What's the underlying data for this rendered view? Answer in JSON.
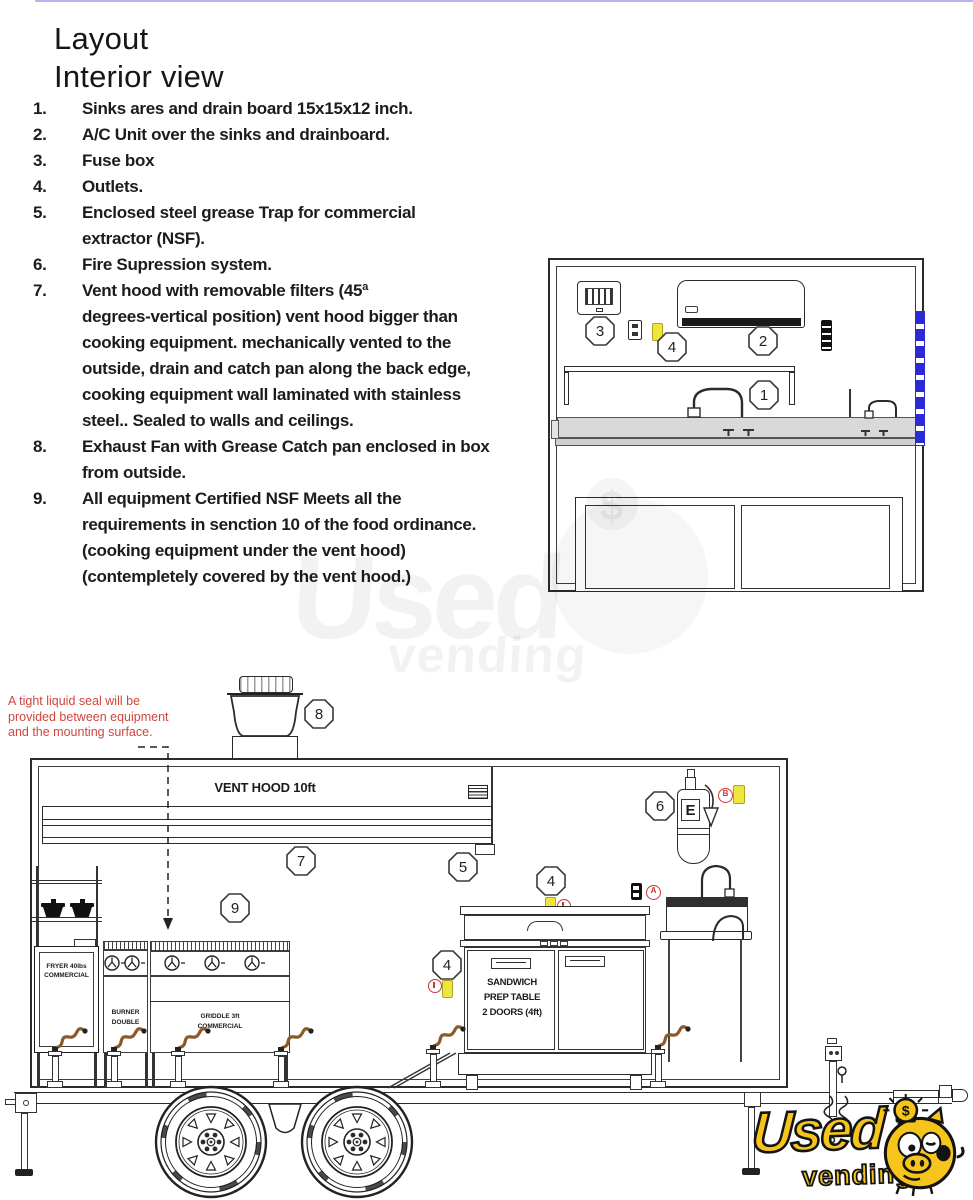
{
  "title": {
    "line1": "Layout",
    "line2": "Interior view"
  },
  "list": [
    {
      "num": "1.",
      "text": "Sinks ares and drain board 15x15x12 inch."
    },
    {
      "num": "2.",
      "text": "A/C Unit over the sinks and drainboard."
    },
    {
      "num": "3.",
      "text": "Fuse box"
    },
    {
      "num": "4.",
      "text": "Outlets."
    },
    {
      "num": "5.",
      "text": "Enclosed steel grease Trap for commercial\nextractor (NSF)."
    },
    {
      "num": "6.",
      "text": "Fire Supression system."
    },
    {
      "num": "7.",
      "text": "Vent hood with removable filters (45ª\ndegrees-vertical position) vent hood bigger than\ncooking equipment. mechanically vented to the\noutside, drain and catch pan along the back edge,\ncooking equipment wall laminated with stainless\nsteel.. Sealed to walls and ceilings."
    },
    {
      "num": "8.",
      "text": "Exhaust Fan with Grease Catch pan enclosed in box\nfrom outside."
    },
    {
      "num": "9.",
      "text": "All equipment Certified NSF Meets all the\nrequirements in senction 10 of the food ordinance.\n(cooking equipment under the vent hood)\n(contempletely covered by the vent hood.)"
    }
  ],
  "callouts": {
    "n1": "1",
    "n2": "2",
    "n3": "3",
    "n4": "4",
    "n5": "5",
    "n6": "6",
    "n7": "7",
    "n8": "8",
    "n9": "9"
  },
  "side": {
    "note": "A tight liquid seal will be\nprovided between equipment\nand the mounting surface.",
    "vent_hood_label": "VENT HOOD 10ft",
    "fryer_label": "FRYER 40lbs\nCOMMERCIAL",
    "burner_label": "BURNER\nDOUBLE",
    "griddle_label": "GRIDDLE 3ft\nCOMMERCIAL",
    "prep_table_label": "SANDWICH\nPREP TABLE\n2 DOORS (4ft)",
    "extinguisher_label": "E",
    "badge_a": "A",
    "badge_b": "B"
  },
  "watermark": {
    "word1": "Used",
    "word2": "vending",
    "coin_symbol": "$"
  },
  "logo": {
    "word1": "Used",
    "word2": "vending",
    "coin_symbol": "$"
  },
  "colors": {
    "note_red": "#d0453e",
    "tag_yellow": "#efe63c",
    "badge_red": "#c93434",
    "strip_blue": "#2b2bd6",
    "logo_yellow": "#f6c51c",
    "hose_brown": "#8a5a2a",
    "line_dark": "#2b2b2b"
  }
}
